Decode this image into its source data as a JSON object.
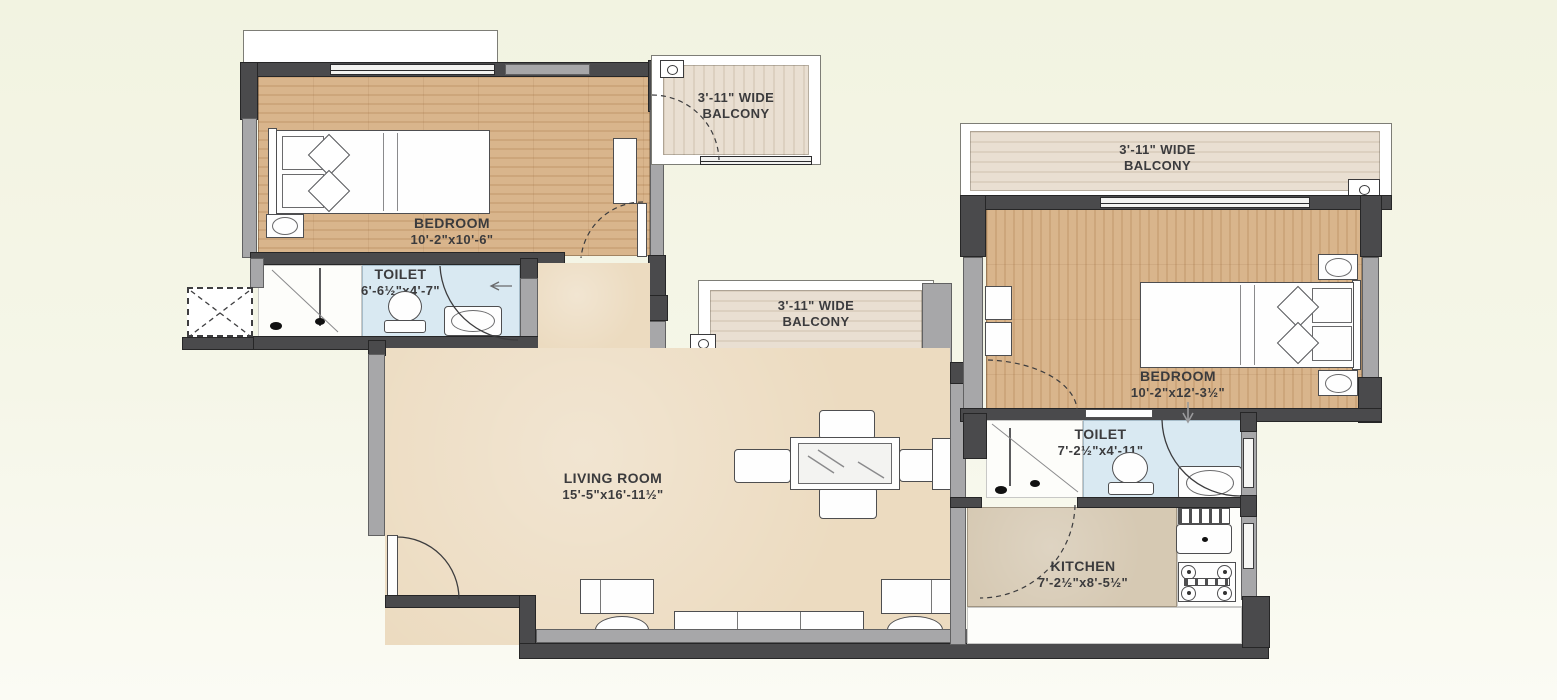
{
  "plan": {
    "title": "2BHK Apartment Floor Plan",
    "rooms": {
      "bedroom1": {
        "name": "BEDROOM",
        "dims": "10'-2\"x10'-6\""
      },
      "toilet1": {
        "name": "TOILET",
        "dims": "6'-6½\"x4'-7\""
      },
      "balcony_top_mid": {
        "line1": "3'-11\" WIDE",
        "line2": "BALCONY"
      },
      "balcony_center": {
        "line1": "3'-11\" WIDE",
        "line2": "BALCONY"
      },
      "balcony_top_right": {
        "line1": "3'-11\" WIDE",
        "line2": "BALCONY"
      },
      "bedroom2": {
        "name": "BEDROOM",
        "dims": "10'-2\"x12'-3½\""
      },
      "toilet2": {
        "name": "TOILET",
        "dims": "7'-2½\"x4'-11\""
      },
      "living": {
        "name": "LIVING ROOM",
        "dims": "15'-5\"x16'-11½\""
      },
      "kitchen": {
        "name": "KITCHEN",
        "dims": "7'-2½\"x8'-5½\""
      }
    },
    "colors": {
      "background": "#f2f3e1",
      "wood": "#d9b58c",
      "wood_light": "#e9dfd2",
      "living_floor": "#ecdbc0",
      "toilet_floor": "#d9e9f2",
      "kitchen_floor": "#d6c9b3",
      "wall_dark": "#4a4a4c",
      "wall_light": "#a7a7a9"
    }
  }
}
